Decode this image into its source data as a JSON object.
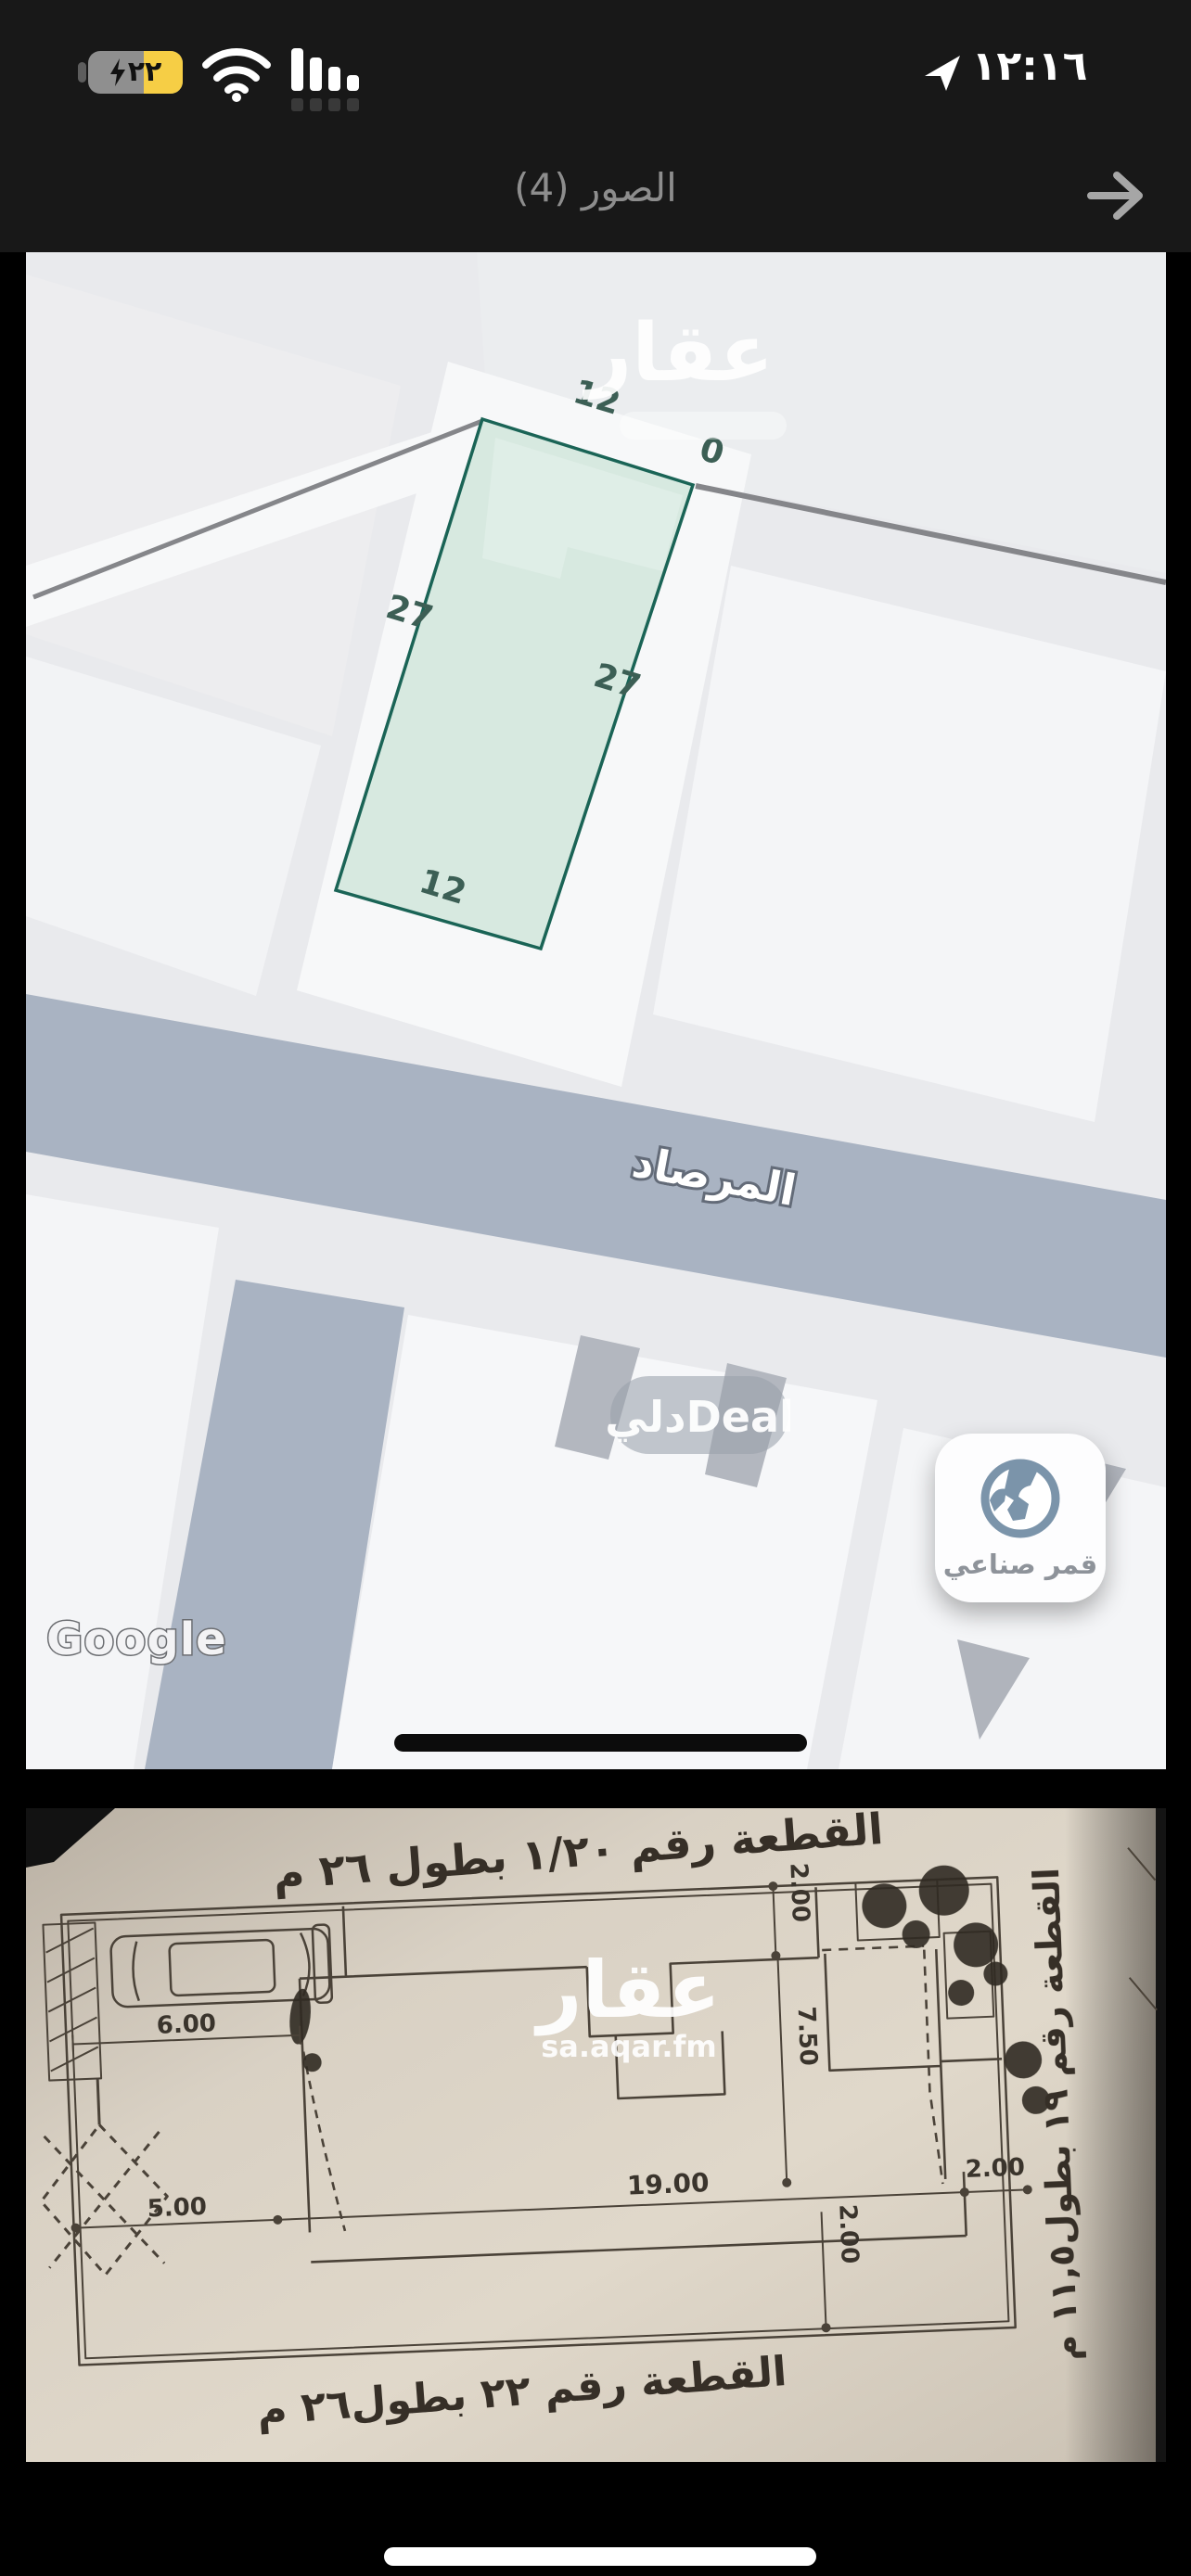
{
  "status_bar": {
    "time": "١٢:١٦",
    "battery_percent": "٢٢"
  },
  "nav": {
    "title": "الصور (4)"
  },
  "icons": {
    "back": "arrow-right-icon",
    "location": "location-arrow-icon",
    "battery_bolt": "charging-bolt-icon",
    "wifi": "wifi-icon",
    "cellular": "cellular-bars-icon",
    "satellite": "globe-icon"
  },
  "colors": {
    "battery_low_power": "#f6ce45",
    "plot_fill": "#cfe5db",
    "plot_stroke": "#1a6456",
    "road": "#a9b3c2",
    "paper": "#d8d0c3"
  },
  "map": {
    "plot": {
      "top": "12",
      "top_right": "0",
      "left": "27",
      "right": "27",
      "bottom": "12"
    },
    "street": "المرصاد",
    "watermark": "عقار",
    "watermark_pill": "دليDeal",
    "google": "Google",
    "satellite_label": "قمر صناعي"
  },
  "floorplan": {
    "title_top": "القطعة رقم ١/٢٠ بطول ٢٦ م",
    "title_bottom": "القطعة رقم ٢٢ بطول٢٦ م",
    "side_label": "القطعة رقم ١٩ بطول١١,٥ م",
    "watermark": "عقار",
    "watermark_sub": "sa.aqar.fm",
    "dims": {
      "six": "6.00",
      "five": "5.00",
      "nineteen": "19.00",
      "two_a": "2.00",
      "two_b": "2.00",
      "seven_half": "7.50",
      "two_c": "2.00"
    }
  }
}
